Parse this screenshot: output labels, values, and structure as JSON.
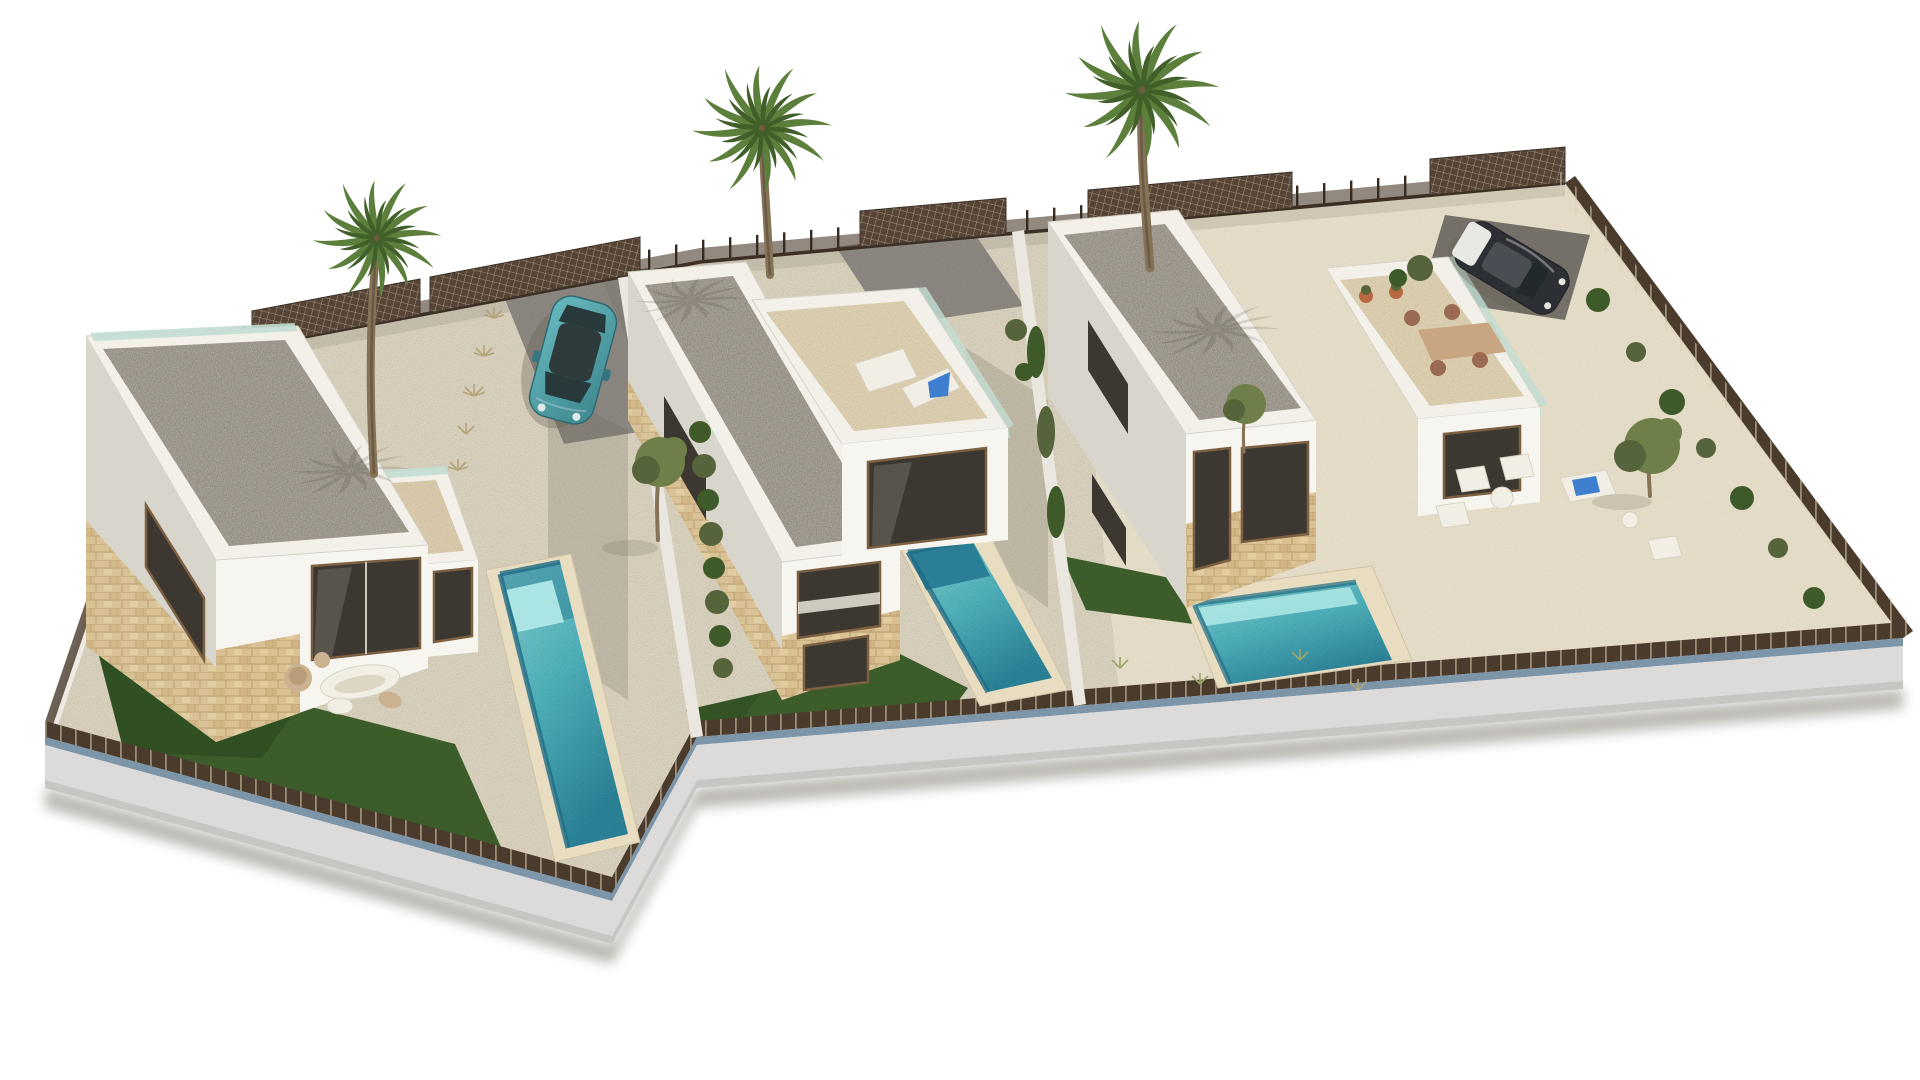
{
  "scene": {
    "type": "3d-architectural-render",
    "description": "Aerial 3D render of a fenced residential plot with three modern two-storey white villas, each with a flat gravel roof, stone-clad accents, a private turquoise pool, an artificial lawn and terraces; three tall palm trees, garden furniture, a teal hatchback parked by the left villa and a dark car parked in the top-right corner",
    "villas": [
      {
        "id": 1,
        "position": "left",
        "features": [
          "flat gravel roof",
          "stone-clad lower facade",
          "terrace with organic white loungers",
          "private pool",
          "lawn",
          "parking pad with teal car"
        ]
      },
      {
        "id": 2,
        "position": "middle",
        "features": [
          "flat gravel roof",
          "roof terrace with two sun loungers",
          "private pool",
          "lawn",
          "gravel driveway"
        ]
      },
      {
        "id": 3,
        "position": "right",
        "features": [
          "flat gravel roof",
          "roof terrace with dining table and chairs",
          "private pool",
          "lawn",
          "garden lounge furniture",
          "corner parking with dark car"
        ]
      }
    ],
    "counts": {
      "pools": 3,
      "palm_trees": 3,
      "cars": 2,
      "lawns": 3
    },
    "cars": [
      {
        "color_name": "teal"
      },
      {
        "color_name": "dark grey, open tailgate"
      }
    ],
    "palette": {
      "bg": "#ffffff",
      "sand": "#e7dfca",
      "sand_light": "#f1e9d3",
      "pad": "#96918a",
      "pad_dark": "#7f7a72",
      "lawn": "#42652e",
      "lawn_dark": "#2e4b20",
      "coping": "#e9ddc1",
      "pool_light": "#8fdbdc",
      "pool_mid": "#54bcc6",
      "pool_dark": "#2a7e95",
      "pool_steps": "#b5ecea",
      "wall": "#f7f5ef",
      "wall_shade": "#d8d5cd",
      "parapet": "#f2f0e9",
      "roof_gravel": "#b6afa3",
      "stone": "#d9c193",
      "stone_dark": "#b99a6a",
      "glass": "#3c3831",
      "frame": "#7d5f41",
      "balustrade": "#c2ddd2",
      "fence": "#4a3b2d",
      "fence_light": "#c9b89b",
      "blue_strip": "#7d95a9",
      "plinth": "#dcdbd9",
      "plinth_side": "#c7c6c3",
      "shadow": "#6b6455",
      "hedge": "#3d5a28",
      "olive": "#6f7f4a",
      "olive_dark": "#55643a",
      "tan": "#cbb391",
      "white_furn": "#f1eee6",
      "trunk": "#857358",
      "palm": "#5d7f3c",
      "palm_dark": "#415f29",
      "car_teal": "#4fa0a8",
      "car_teal_dark": "#37767e",
      "car_dark": "#2c2f33",
      "car_glass": "#27393b"
    }
  }
}
